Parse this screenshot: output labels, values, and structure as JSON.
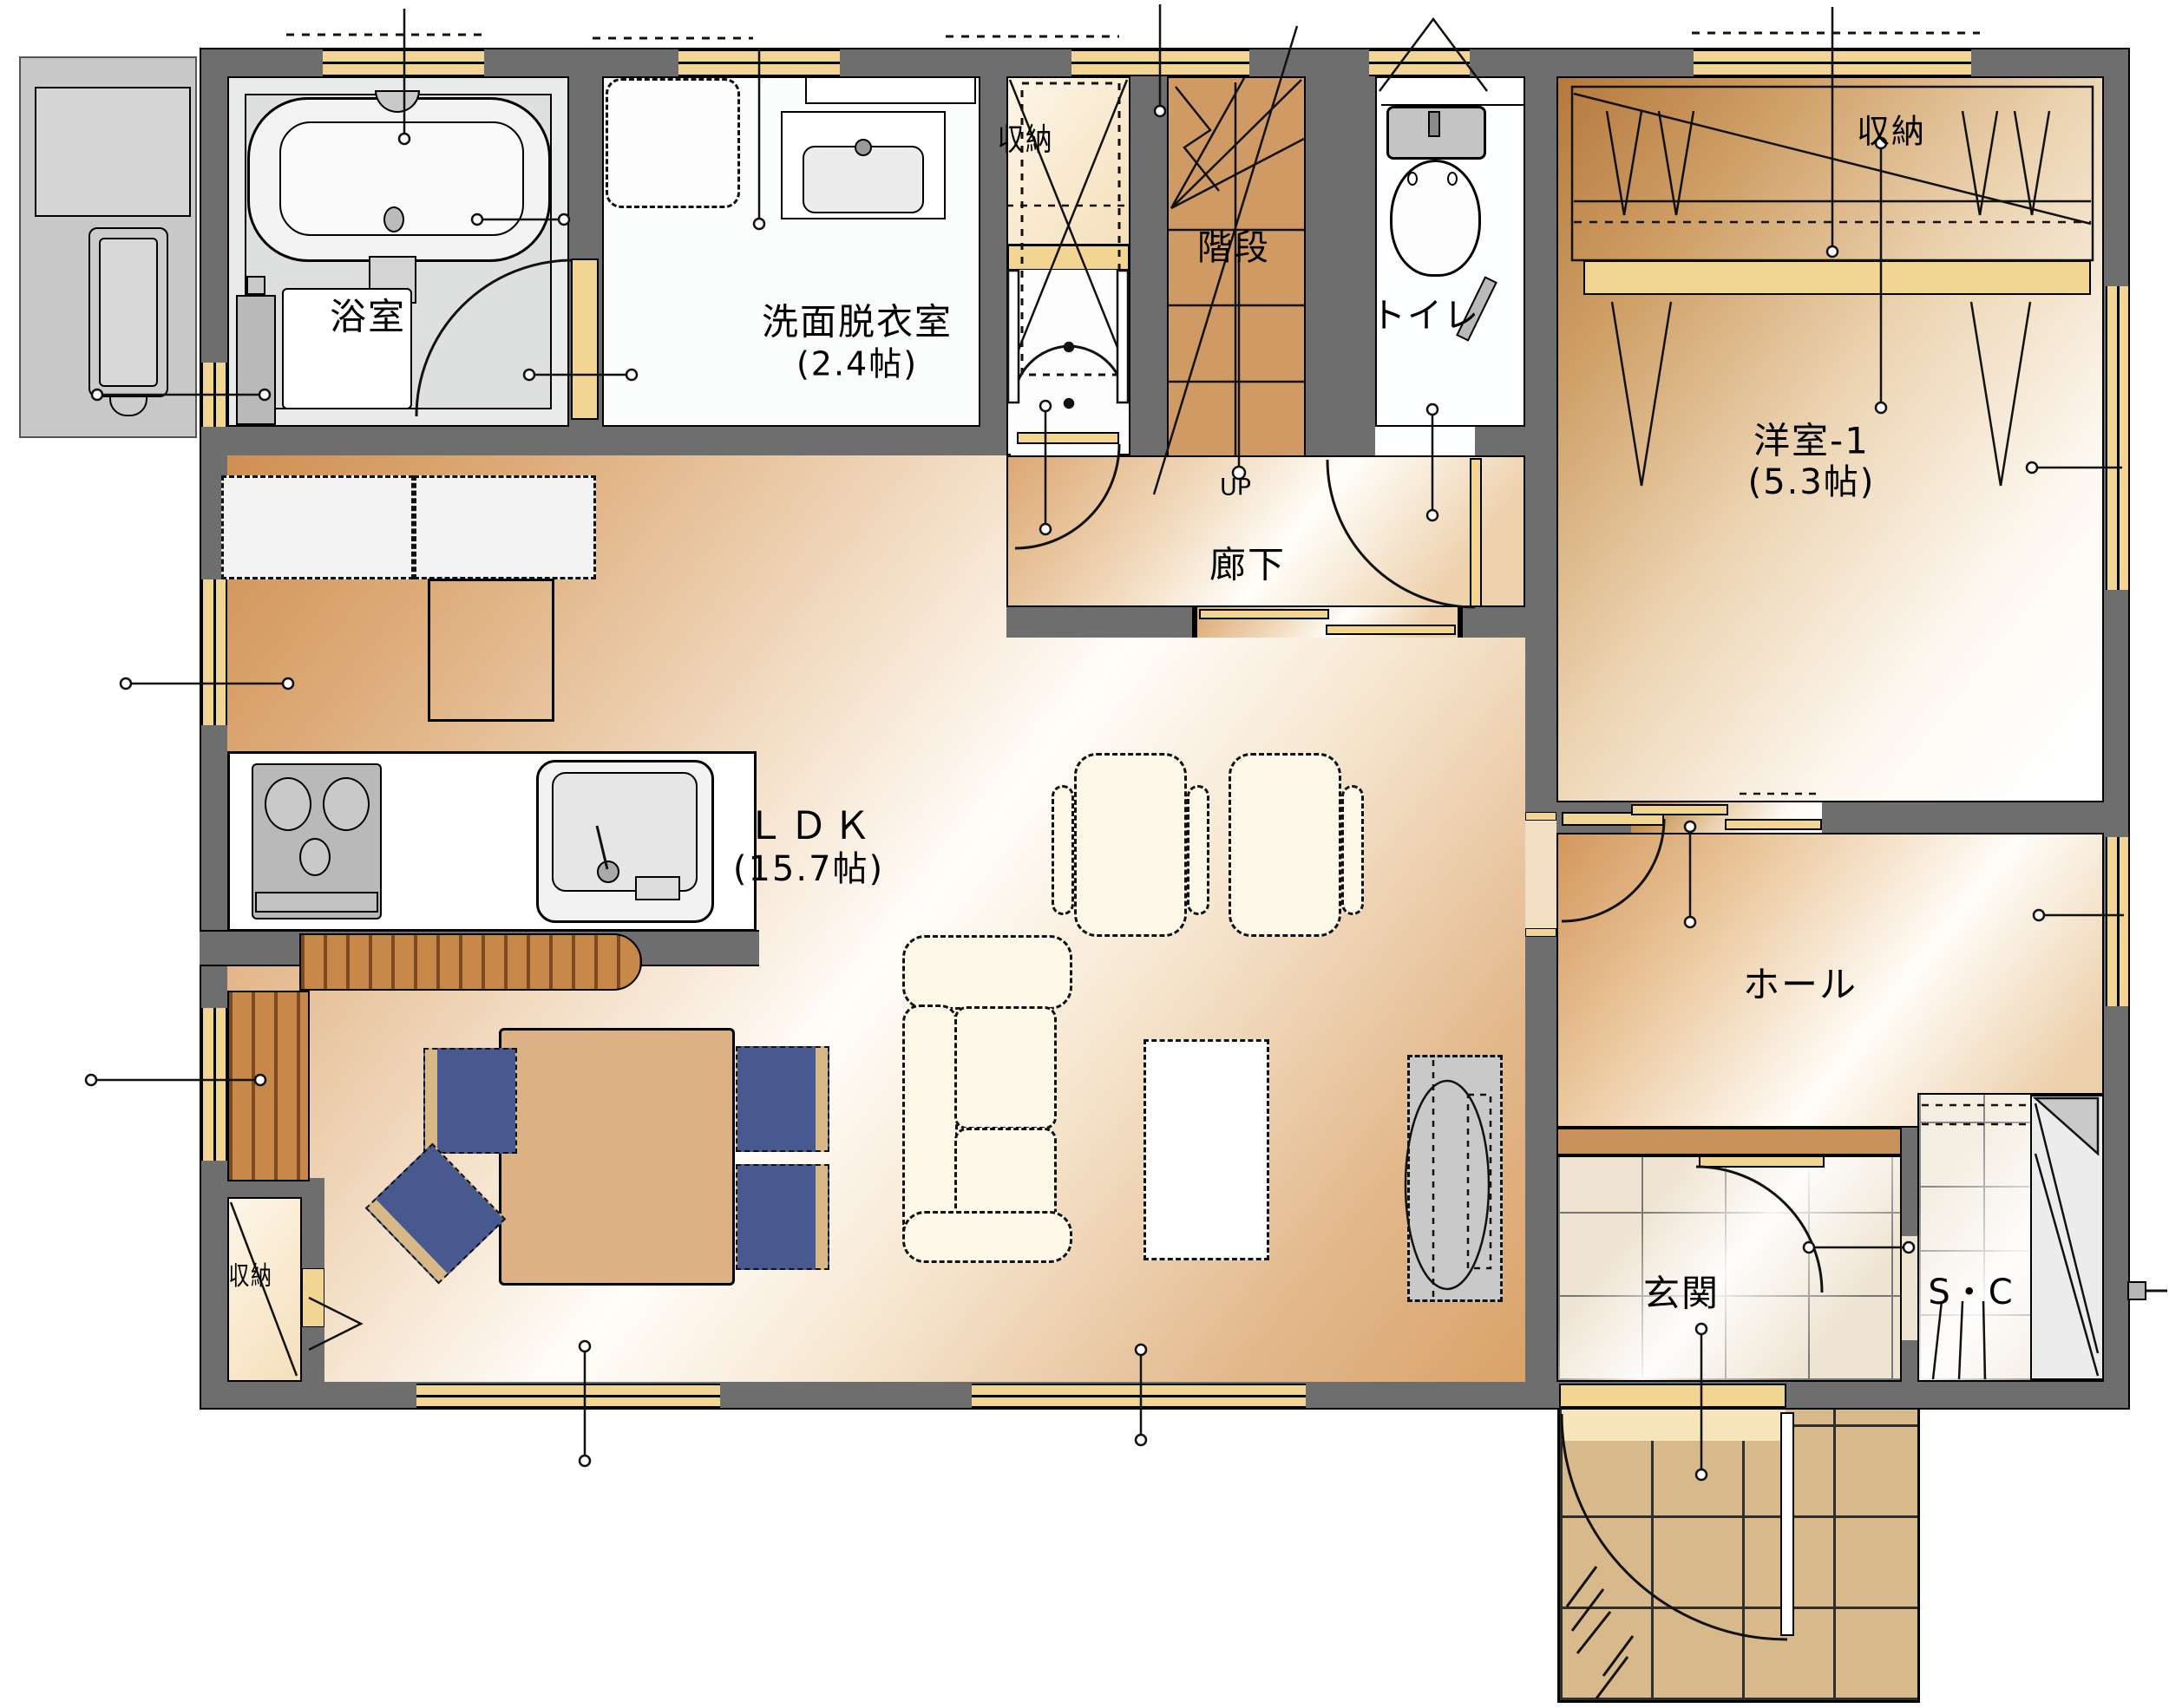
{
  "rooms": {
    "bathroom": {
      "label": "浴室"
    },
    "washroom": {
      "label": "洗面脱衣室",
      "size": "(2.4帖)"
    },
    "stair_closet": {
      "label": "収納"
    },
    "stairs": {
      "label": "階段",
      "direction": "UP"
    },
    "toilet": {
      "label": "トイレ"
    },
    "western_room": {
      "label": "洋室-1",
      "size": "(5.3帖)"
    },
    "western_closet": {
      "label": "収納"
    },
    "corridor": {
      "label": "廊下"
    },
    "ldk": {
      "label": "ＬＤＫ",
      "size": "(15.7帖)"
    },
    "hall": {
      "label": "ホール"
    },
    "entrance": {
      "label": "玄関"
    },
    "shoe_closet": {
      "label": "S・C"
    },
    "ldk_closet": {
      "label": "収納"
    }
  },
  "colors": {
    "wall": "#6e6e6e",
    "window": "#f2d592",
    "stairs_floor": "#cf9a63",
    "wood_dark": "#c98746",
    "porch_tile": "#d8b98b",
    "entrance_tile": "#efe4d2",
    "chair_blue": "#47598f",
    "sofa_cream": "#fdf8e7",
    "table_wood": "#dcb183",
    "step_edge": "#c8915a"
  }
}
